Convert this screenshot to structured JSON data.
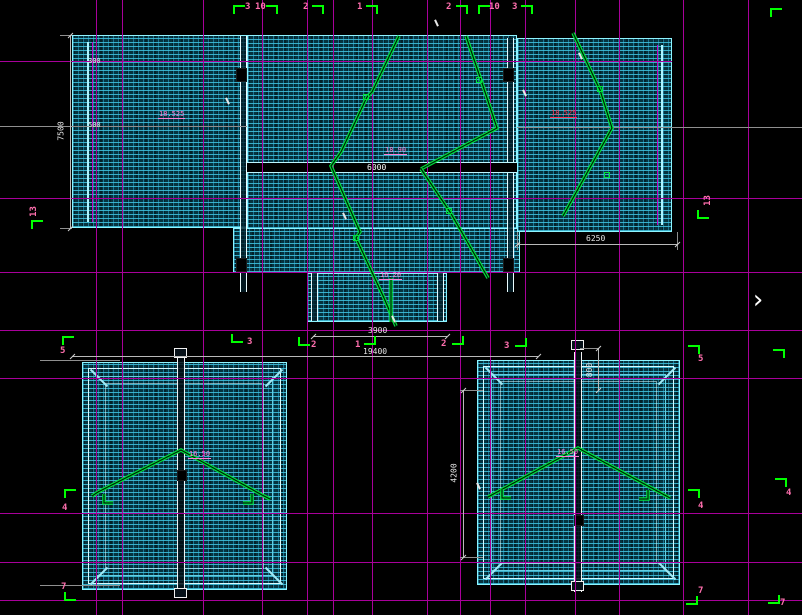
{
  "viewport": {
    "width": 802,
    "height": 615,
    "background": "#000000"
  },
  "palette": {
    "grid_magenta": "#a8009a",
    "hatch_teal": "#2e9dbf",
    "eave_cyan": "#8ff4ff",
    "trim_magenta": "#c400c4",
    "green": "#00e23c",
    "bracket_green": "#00ff00",
    "label_pink": "#ff6fae",
    "dim_gray": "#cfcfcf",
    "elev_red": "#ff2e4e",
    "elev_pink": "#ff7fd4",
    "arrow_white": "#ffffff"
  },
  "side_arrow": {
    "glyph": "›"
  },
  "grid": {
    "vertical_x": [
      96,
      122,
      203,
      262,
      307,
      333,
      372,
      427,
      460,
      490,
      525,
      575,
      619,
      683,
      748
    ],
    "horizontal_y": [
      198,
      272,
      330,
      378,
      513,
      562,
      600
    ],
    "partial_horizontal": [
      {
        "y": 61,
        "x1": 0,
        "x2": 672
      }
    ]
  },
  "roofs": [
    {
      "name": "top-plan-left-wing",
      "x": 72,
      "y": 35,
      "w": 175,
      "h": 193,
      "inner": false
    },
    {
      "name": "top-plan-center",
      "x": 247,
      "y": 35,
      "w": 270,
      "h": 238,
      "inner": false
    },
    {
      "name": "top-plan-ext-upper",
      "x": 233,
      "y": 228,
      "w": 287,
      "h": 45,
      "inner": false
    },
    {
      "name": "top-plan-ext-lower",
      "x": 307,
      "y": 273,
      "w": 140,
      "h": 49,
      "inner": false
    },
    {
      "name": "top-plan-right-wing",
      "x": 517,
      "y": 38,
      "w": 155,
      "h": 194,
      "inner": false
    },
    {
      "name": "bottom-left-plan",
      "x": 82,
      "y": 362,
      "w": 205,
      "h": 228,
      "inner": true
    },
    {
      "name": "bottom-right-plan",
      "x": 477,
      "y": 360,
      "w": 203,
      "h": 225,
      "inner": true
    }
  ],
  "strips": [
    {
      "name": "valley-strip-left",
      "style": "s-valley",
      "x": 240,
      "y1": 36,
      "y2": 292
    },
    {
      "name": "valley-strip-right",
      "style": "s-valley",
      "x": 507,
      "y1": 38,
      "y2": 292
    },
    {
      "name": "ext-gable-left",
      "style": "s-valley",
      "x": 311,
      "y1": 273,
      "y2": 321
    },
    {
      "name": "ext-gable-right",
      "style": "s-valley",
      "x": 437,
      "y1": 273,
      "y2": 321
    },
    {
      "name": "left-wing-gable",
      "style": "s-gableL",
      "x": 87,
      "y1": 42,
      "y2": 222
    },
    {
      "name": "right-wing-gable",
      "style": "s-gableR",
      "x": 657,
      "y1": 45,
      "y2": 225
    },
    {
      "name": "bottom-left-pole",
      "style": "s-pole",
      "x": 177,
      "y1": 352,
      "y2": 598
    },
    {
      "name": "bottom-right-pole",
      "style": "s-pole",
      "x": 574,
      "y1": 352,
      "y2": 592
    }
  ],
  "pole_caps": [
    {
      "x": 174,
      "y": 348,
      "w": 13,
      "h": 10
    },
    {
      "x": 174,
      "y": 588,
      "w": 13,
      "h": 10
    },
    {
      "x": 571,
      "y": 340,
      "w": 13,
      "h": 10
    },
    {
      "x": 571,
      "y": 581,
      "w": 13,
      "h": 10
    }
  ],
  "node_squares": [
    {
      "x": 236,
      "y": 68,
      "w": 9,
      "h": 12
    },
    {
      "x": 236,
      "y": 258,
      "w": 9,
      "h": 12
    },
    {
      "x": 503,
      "y": 68,
      "w": 9,
      "h": 12
    },
    {
      "x": 503,
      "y": 258,
      "w": 9,
      "h": 12
    },
    {
      "x": 177,
      "y": 470,
      "w": 8,
      "h": 9
    },
    {
      "x": 574,
      "y": 515,
      "w": 8,
      "h": 9
    }
  ],
  "ridge_band": {
    "x": 247,
    "y": 162,
    "w": 270,
    "h": 11,
    "label": "6000",
    "label_x": 120
  },
  "gray_lines": [
    {
      "x1": 0,
      "y1": 126,
      "x2": 247,
      "y2": 126
    },
    {
      "x1": 517,
      "y1": 127,
      "x2": 802,
      "y2": 127
    },
    {
      "x1": 60,
      "y1": 35,
      "x2": 72,
      "y2": 35
    },
    {
      "x1": 60,
      "y1": 228,
      "x2": 72,
      "y2": 228
    },
    {
      "x1": 40,
      "y1": 360,
      "x2": 120,
      "y2": 360
    },
    {
      "x1": 40,
      "y1": 585,
      "x2": 120,
      "y2": 585
    },
    {
      "x1": 460,
      "y1": 390,
      "x2": 483,
      "y2": 390
    },
    {
      "x1": 460,
      "y1": 557,
      "x2": 483,
      "y2": 557
    },
    {
      "x1": 517,
      "y1": 232,
      "x2": 517,
      "y2": 250
    },
    {
      "x1": 677,
      "y1": 232,
      "x2": 677,
      "y2": 250
    },
    {
      "x1": 580,
      "y1": 348,
      "x2": 598,
      "y2": 348
    }
  ],
  "dimensions": [
    {
      "name": "dim-7500",
      "text": "7500",
      "x1": 70,
      "y1": 35,
      "x2": 70,
      "y2": 228,
      "tx": 52,
      "ty": 127,
      "rot": true
    },
    {
      "name": "dim-6250",
      "text": "6250",
      "x1": 517,
      "y1": 244,
      "x2": 677,
      "y2": 244,
      "tx": 586,
      "ty": 235,
      "rot": false
    },
    {
      "name": "dim-3900",
      "text": "3900",
      "x1": 313,
      "y1": 336,
      "x2": 447,
      "y2": 336,
      "tx": 368,
      "ty": 327,
      "rot": false
    },
    {
      "name": "dim-19400",
      "text": "19400",
      "x1": 72,
      "y1": 356,
      "x2": 538,
      "y2": 356,
      "tx": 363,
      "ty": 348,
      "rot": false
    },
    {
      "name": "dim-4200",
      "text": "4200",
      "x1": 463,
      "y1": 390,
      "x2": 463,
      "y2": 557,
      "tx": 445,
      "ty": 469,
      "rot": true
    },
    {
      "name": "dim-800",
      "text": "800",
      "x1": 598,
      "y1": 348,
      "x2": 598,
      "y2": 390,
      "tx": 583,
      "ty": 366,
      "rot": true
    }
  ],
  "small_texts": [
    {
      "text": "300",
      "x": 88,
      "y": 57
    },
    {
      "text": "500",
      "x": 88,
      "y": 121
    }
  ],
  "elevations": [
    {
      "text": "18.525",
      "x": 158,
      "y": 111,
      "color": "#ff7fd4"
    },
    {
      "text": "18.525",
      "x": 550,
      "y": 110,
      "color": "#ff2e4e"
    },
    {
      "text": "18.90",
      "x": 384,
      "y": 147,
      "color": "#ff7fd4"
    },
    {
      "text": "16.20",
      "x": 379,
      "y": 272,
      "color": "#ff7fd4"
    },
    {
      "text": "16.50",
      "x": 188,
      "y": 451,
      "color": "#ff7fd4"
    },
    {
      "text": "16.50",
      "x": 556,
      "y": 449,
      "color": "#ff7fd4"
    }
  ],
  "grid_bubble_labels": [
    {
      "text": "3",
      "x": 245,
      "y": 3,
      "rot": false
    },
    {
      "text": "10",
      "x": 255,
      "y": 3,
      "rot": false
    },
    {
      "text": "2",
      "x": 303,
      "y": 3,
      "rot": false
    },
    {
      "text": "1",
      "x": 357,
      "y": 3,
      "rot": false
    },
    {
      "text": "2",
      "x": 446,
      "y": 3,
      "rot": false
    },
    {
      "text": "10",
      "x": 489,
      "y": 3,
      "rot": false
    },
    {
      "text": "3",
      "x": 512,
      "y": 3,
      "rot": false
    },
    {
      "text": "3",
      "x": 247,
      "y": 338,
      "rot": false
    },
    {
      "text": "2",
      "x": 311,
      "y": 341,
      "rot": false
    },
    {
      "text": "1",
      "x": 355,
      "y": 341,
      "rot": false
    },
    {
      "text": "2",
      "x": 441,
      "y": 340,
      "rot": false
    },
    {
      "text": "3",
      "x": 504,
      "y": 342,
      "rot": false
    },
    {
      "text": "13",
      "x": 29,
      "y": 207,
      "rot": true
    },
    {
      "text": "13",
      "x": 703,
      "y": 196,
      "rot": true
    },
    {
      "text": "5",
      "x": 60,
      "y": 347,
      "rot": false
    },
    {
      "text": "4",
      "x": 62,
      "y": 504,
      "rot": false
    },
    {
      "text": "7",
      "x": 61,
      "y": 583,
      "rot": false
    },
    {
      "text": "5",
      "x": 698,
      "y": 355,
      "rot": false
    },
    {
      "text": "4",
      "x": 698,
      "y": 502,
      "rot": false
    },
    {
      "text": "7",
      "x": 698,
      "y": 587,
      "rot": false
    },
    {
      "text": "4",
      "x": 786,
      "y": 489,
      "rot": false
    },
    {
      "text": "7",
      "x": 780,
      "y": 599,
      "rot": false
    }
  ],
  "brackets": [
    {
      "type": "tl",
      "x": 233,
      "y": 5
    },
    {
      "type": "tr",
      "x": 266,
      "y": 5
    },
    {
      "type": "tr",
      "x": 312,
      "y": 5
    },
    {
      "type": "tr",
      "x": 366,
      "y": 5
    },
    {
      "type": "tr",
      "x": 456,
      "y": 5
    },
    {
      "type": "tl",
      "x": 478,
      "y": 5
    },
    {
      "type": "tr",
      "x": 521,
      "y": 5
    },
    {
      "type": "bl",
      "x": 231,
      "y": 334
    },
    {
      "type": "bl",
      "x": 298,
      "y": 337
    },
    {
      "type": "br",
      "x": 364,
      "y": 336
    },
    {
      "type": "br",
      "x": 452,
      "y": 336
    },
    {
      "type": "br",
      "x": 515,
      "y": 338
    },
    {
      "type": "tl",
      "x": 31,
      "y": 220
    },
    {
      "type": "bl",
      "x": 697,
      "y": 210
    },
    {
      "type": "tl",
      "x": 62,
      "y": 336
    },
    {
      "type": "tl",
      "x": 64,
      "y": 489
    },
    {
      "type": "bl",
      "x": 64,
      "y": 592
    },
    {
      "type": "tr",
      "x": 688,
      "y": 345
    },
    {
      "type": "tr",
      "x": 688,
      "y": 489
    },
    {
      "type": "br",
      "x": 686,
      "y": 596
    },
    {
      "type": "tl",
      "x": 770,
      "y": 8
    },
    {
      "type": "tr",
      "x": 773,
      "y": 349
    },
    {
      "type": "tr",
      "x": 775,
      "y": 478
    },
    {
      "type": "br",
      "x": 768,
      "y": 595
    }
  ],
  "green_paths": [
    {
      "name": "hip-line-center-left",
      "d": "M399,36 L372,92 L367,97 L341,152 L331,166 L360,232 L356,238 L384,298 L396,326"
    },
    {
      "name": "hip-line-center-upper",
      "d": "M466,36 L481,80 L497,128 L421,169"
    },
    {
      "name": "hip-line-center-lower",
      "d": "M421,169 L450,212 L468,243 L488,278"
    },
    {
      "name": "ridge-ext-vertical",
      "d": "M391,278 L391,322"
    },
    {
      "name": "hip-line-right-wing",
      "d": "M573,33 L600,90 L612,128 L563,216"
    },
    {
      "name": "hip-bottom-left",
      "d": "M92,496 L98,492 L181,450 L262,495 L270,499"
    },
    {
      "name": "hip-bottom-left-hook1",
      "d": "M104,494 L104,503 L113,503"
    },
    {
      "name": "hip-bottom-left-hook2",
      "d": "M252,494 L252,503 L243,503"
    },
    {
      "name": "hip-bottom-right",
      "d": "M488,497 L578,448 L670,498"
    },
    {
      "name": "hip-bottom-right-hook1",
      "d": "M502,489 L502,498 L511,498"
    },
    {
      "name": "hip-bottom-right-hook2",
      "d": "M648,490 L648,499 L639,499"
    }
  ],
  "green_jogs": [
    {
      "x": 363,
      "y": 94
    },
    {
      "x": 353,
      "y": 235
    },
    {
      "x": 476,
      "y": 77
    },
    {
      "x": 446,
      "y": 208
    },
    {
      "x": 597,
      "y": 86
    },
    {
      "x": 604,
      "y": 172
    }
  ],
  "annotation_marks": [
    {
      "x": 224,
      "y": 100
    },
    {
      "x": 341,
      "y": 215
    },
    {
      "x": 433,
      "y": 22
    },
    {
      "x": 521,
      "y": 92
    },
    {
      "x": 577,
      "y": 55
    },
    {
      "x": 475,
      "y": 485
    },
    {
      "x": 390,
      "y": 318
    }
  ]
}
